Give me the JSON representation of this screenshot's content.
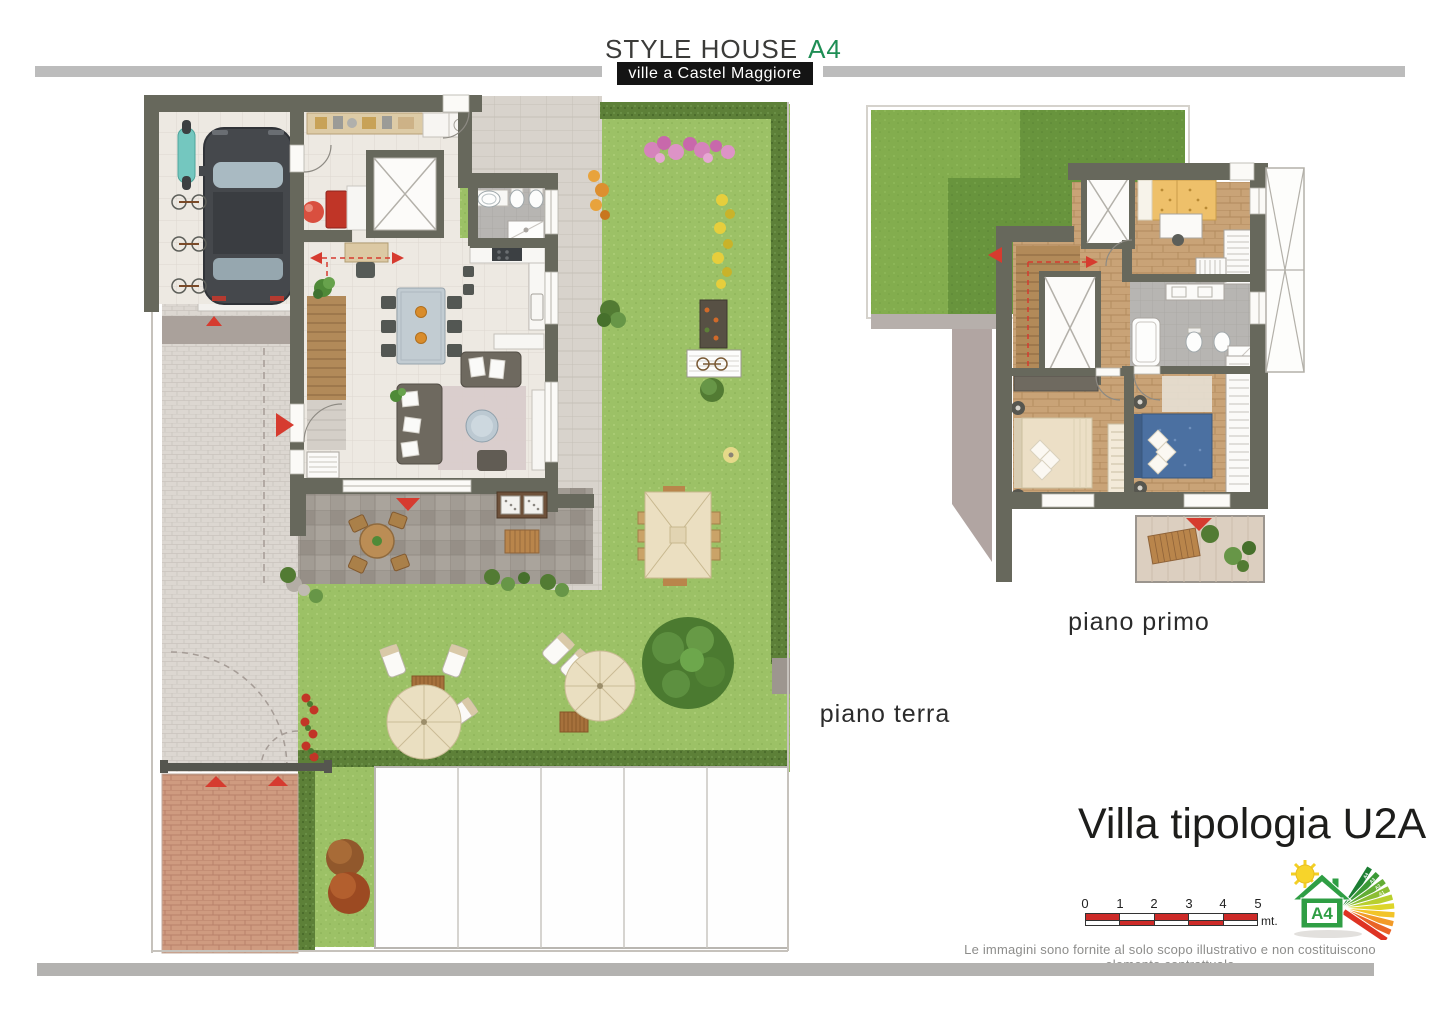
{
  "header": {
    "title": "STYLE HOUSE",
    "model": "A4",
    "subtitle": "ville a Castel Maggiore"
  },
  "plans": {
    "ground_floor_label": "piano terra",
    "first_floor_label": "piano primo"
  },
  "villa": {
    "title": "Villa tipologia U2A"
  },
  "scale_bar": {
    "ticks": [
      "0",
      "1",
      "2",
      "3",
      "4",
      "5"
    ],
    "unit": "mt."
  },
  "energy_logo": {
    "class_label": "A4",
    "bar_labels": [
      "A4",
      "A3",
      "A2",
      "A1",
      "B",
      "C",
      "D",
      "E",
      "F",
      "G"
    ]
  },
  "footer": {
    "disclaimer": "Le immagini sono fornite al solo scopo illustrativo e non costituiscono elemento contrattuale"
  },
  "colors": {
    "brand_green": "#1f8e55",
    "header_box": "#141414",
    "bar_gray": "#bcbcbc",
    "wall": "#67685c",
    "lawn": "#9cc166",
    "hedge": "#5d8038",
    "roof_lawn_light": "#83ad4e",
    "roof_lawn_dark": "#68943d",
    "brick": "#cf9b80",
    "scale_red": "#cd2a28",
    "marker_red": "#d63b2f",
    "parquet": "#c9a377",
    "blue_bed": "#4b70a1"
  }
}
